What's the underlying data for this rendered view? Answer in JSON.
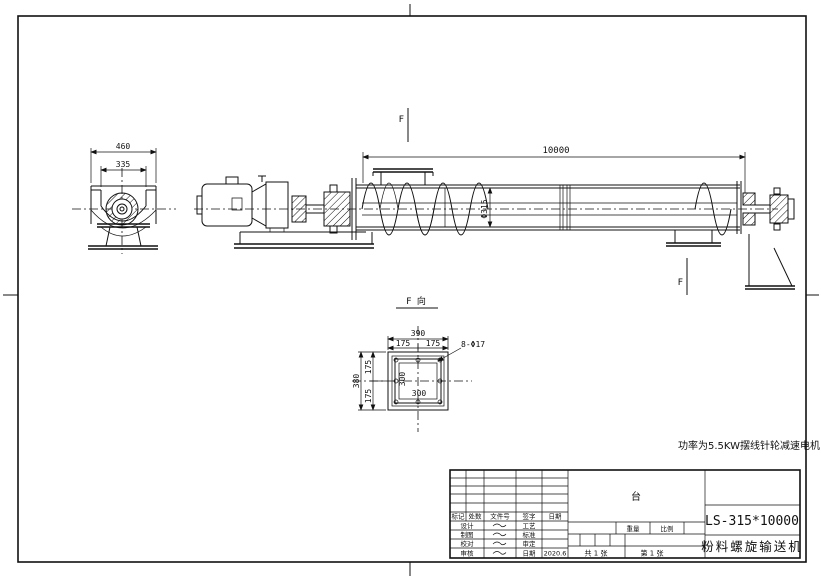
{
  "end_view": {
    "dim_width": "460",
    "dim_inner": "335"
  },
  "main_view": {
    "dim_length": "10000",
    "dim_diameter": "Φ315",
    "view_arrow_top": "F",
    "view_arrow_bottom": "F"
  },
  "section_view": {
    "title": "F 向",
    "dim_width": "390",
    "dim_w_left": "175",
    "dim_w_right": "175",
    "holes_label": "8-Φ17",
    "dim_height": "380",
    "dim_h_top": "175",
    "dim_h_bottom": "175",
    "dim_inner_w": "300",
    "dim_inner_h": "300"
  },
  "note": {
    "text": "功率为5.5KW摆线针轮减速电机"
  },
  "title_block": {
    "header": [
      "标记",
      "处数",
      "文件号",
      "签字",
      "日期"
    ],
    "rows": [
      {
        "left": "设计",
        "mid": "工艺",
        "val": ""
      },
      {
        "left": "制图",
        "mid": "标准",
        "val": ""
      },
      {
        "left": "校对",
        "mid": "审定",
        "val": ""
      },
      {
        "left": "审核",
        "mid": "日期",
        "val": "2020.6"
      }
    ],
    "unit": "台",
    "weight_label": "重量",
    "scale_label": "比例",
    "sheet_total": "共 1 张",
    "sheet_no": "第 1 张",
    "model": "LS-315*10000",
    "product_name": "粉料螺旋输送机"
  },
  "colors": {
    "ink": "#111111",
    "paper": "#ffffff"
  }
}
